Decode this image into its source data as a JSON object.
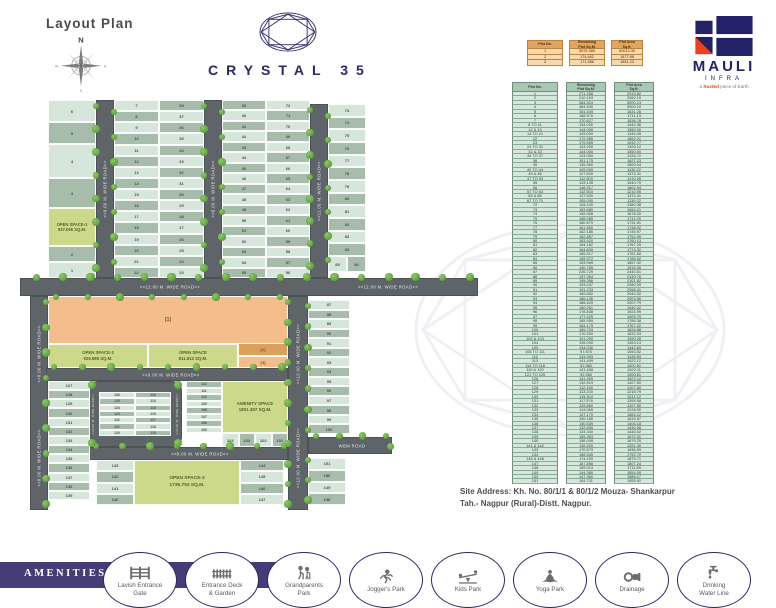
{
  "header": {
    "layout_plan": "Layout Plan",
    "project_title": "CRYSTAL 35"
  },
  "brand": {
    "name": "MAULI",
    "sub": "INFRA",
    "tagline_pre": "a ",
    "tagline_em": "trusted",
    "tagline_post": " piece of Earth"
  },
  "compass": {
    "n": "N",
    "e": "E",
    "s": "S",
    "w": "W"
  },
  "colors": {
    "accent_navy": "#2b2866",
    "brand_red": "#e8431e",
    "road_gray": "#5f6468",
    "plot_light": "#d7e6da",
    "plot_dark": "#a7bcab",
    "open_space_green": "#ccd98b",
    "orange_plot": "#f3bd8c",
    "orange_plot_dark": "#dba15c",
    "amenities_band": "#453c78",
    "table_green_row": "#d6e8dc",
    "table_orange_row": "#f8d9ae"
  },
  "summary_table": {
    "headers": [
      "Plot No.",
      "Remaining\nPlot Sq.M.",
      "Plot Area\nSq.ft."
    ],
    "rows": [
      [
        "1",
        "5575.380",
        "60013.39"
      ],
      [
        "2",
        "174.462",
        "1877.88"
      ],
      [
        "3",
        "171.986",
        "1851.23"
      ]
    ]
  },
  "plot_table": {
    "headers": [
      "Plot No.",
      "Remaining\nPlot Sq.M.",
      "Plot Area\nSq.ft."
    ],
    "rows": [
      [
        "1",
        "271.258",
        "2919.82"
      ],
      [
        "2",
        "210.163",
        "2262.19"
      ],
      [
        "3",
        "464.524",
        "5000.13"
      ],
      [
        "4",
        "464.530",
        "5000.19"
      ],
      [
        "5",
        "151.549",
        "1631.26"
      ],
      [
        "6",
        "158.970",
        "1711.13"
      ],
      [
        "7",
        "170.827",
        "1838.78"
      ],
      [
        "8 TO 11",
        "134.000",
        "1442.36"
      ],
      [
        "12 & 13",
        "144.000",
        "1550.00"
      ],
      [
        "14 TO 21",
        "125.000",
        "1345.49"
      ],
      [
        "22",
        "172.985",
        "1862.01"
      ],
      [
        "23",
        "179.559",
        "1932.77"
      ],
      [
        "24 TO 31",
        "123.200",
        "1326.12"
      ],
      [
        "32 & 33",
        "144.000",
        "1550.00"
      ],
      [
        "34 TO 37",
        "124.000",
        "1334.72"
      ],
      [
        "38",
        "151.175",
        "1627.23"
      ],
      [
        "39",
        "139.360",
        "1500.04"
      ],
      [
        "40 TO 44",
        "105.000",
        "1130.22"
      ],
      [
        "45 & 46",
        "127.500",
        "1372.41"
      ],
      [
        "47 TO 54",
        "112.500",
        "1210.95"
      ],
      [
        "55",
        "143.135",
        "1540.70"
      ],
      [
        "56",
        "148.917",
        "1602.94"
      ],
      [
        "57 TO 64",
        "112.500",
        "1210.95"
      ],
      [
        "65 & 66",
        "127.500",
        "1372.41"
      ],
      [
        "67 TO 71",
        "105.000",
        "1130.22"
      ],
      [
        "72",
        "128.240",
        "1380.38"
      ],
      [
        "73",
        "153.680",
        "1654.21"
      ],
      [
        "74",
        "155.908",
        "1678.20"
      ],
      [
        "75",
        "158.985",
        "1711.29"
      ],
      [
        "76",
        "160.870",
        "1731.61"
      ],
      [
        "77",
        "161.550",
        "1738.92"
      ],
      [
        "78",
        "162.186",
        "1745.97"
      ],
      [
        "79",
        "162.857",
        "1752.99"
      ],
      [
        "80",
        "163.520",
        "1760.13"
      ],
      [
        "81",
        "164.182",
        "1767.25"
      ],
      [
        "82",
        "164.839",
        "1774.32"
      ],
      [
        "83",
        "165.517",
        "1781.60"
      ],
      [
        "84",
        "165.972",
        "1786.52"
      ],
      [
        "85",
        "153.969",
        "1657.32"
      ],
      [
        "86",
        "140.755",
        "1515.05"
      ],
      [
        "87",
        "226.729",
        "2440.51"
      ],
      [
        "88",
        "197.954",
        "2130.76"
      ],
      [
        "89",
        "195.266",
        "2101.82"
      ],
      [
        "90",
        "193.247",
        "2080.09"
      ],
      [
        "91",
        "191.233",
        "2058.41"
      ],
      [
        "92",
        "189.552",
        "2040.32"
      ],
      [
        "93",
        "186.136",
        "2003.56"
      ],
      [
        "94",
        "186.529",
        "2007.79"
      ],
      [
        "95",
        "180.261",
        "1940.32"
      ],
      [
        "96",
        "178.838",
        "1924.99"
      ],
      [
        "97",
        "177.425",
        "1909.79"
      ],
      [
        "98",
        "165.959",
        "1786.38"
      ],
      [
        "99",
        "164.179",
        "1767.22"
      ],
      [
        "100",
        "169.703",
        "1826.68"
      ],
      [
        "101",
        "170.200",
        "1832.03"
      ],
      [
        "102 & 103",
        "101.290",
        "1090.28"
      ],
      [
        "104",
        "135.000",
        "1453.13"
      ],
      [
        "105",
        "134.030",
        "1442.69"
      ],
      [
        "106 TO 111",
        "97.875",
        "1053.52"
      ],
      [
        "112",
        "133.393",
        "1435.83"
      ],
      [
        "113",
        "141.409",
        "1522.12"
      ],
      [
        "114 TO 118",
        "92.960",
        "1000.61"
      ],
      [
        "119 & 120",
        "141.408",
        "1522.11"
      ],
      [
        "121 TO 125",
        "92.960",
        "1000.61"
      ],
      [
        "126",
        "141.409",
        "1522.12"
      ],
      [
        "127",
        "132.619",
        "1427.50"
      ],
      [
        "128",
        "112.190",
        "1207.60"
      ],
      [
        "129",
        "113.230",
        "1218.79"
      ],
      [
        "130",
        "115.304",
        "1241.12"
      ],
      [
        "131",
        "117.576",
        "1265.58"
      ],
      [
        "132",
        "129.860",
        "1397.80"
      ],
      [
        "133",
        "114.085",
        "1228.00"
      ],
      [
        "134",
        "147.170",
        "1584.12"
      ],
      [
        "135",
        "150.185",
        "1616.57"
      ],
      [
        "136",
        "130.639",
        "1406.18"
      ],
      [
        "137",
        "132.859",
        "1430.08"
      ],
      [
        "138",
        "134.340",
        "1446.02"
      ],
      [
        "139",
        "155.363",
        "1672.31"
      ],
      [
        "140",
        "156.008",
        "1679.25"
      ],
      [
        "141 & 142",
        "116.250",
        "1251.30"
      ],
      [
        "143",
        "170.579",
        "1836.09"
      ],
      [
        "144",
        "166.549",
        "1792.72"
      ],
      [
        "145 & 146",
        "174.259",
        "1875.71"
      ],
      [
        "147",
        "167.898",
        "1807.24"
      ],
      [
        "148",
        "159.013",
        "1711.59"
      ],
      [
        "149",
        "144.380",
        "1554.09"
      ],
      [
        "150",
        "147.360",
        "1586.17"
      ],
      [
        "151",
        "181.711",
        "1955.92"
      ]
    ]
  },
  "map": {
    "road_labels": {
      "r9": "<<9.00 M. WIDE ROAD>>",
      "r11": "<<11.00 M. WIDE ROAD>>",
      "r12": "<<12.00 M. WIDE ROAD>>",
      "wbm": "WBM ROAD"
    },
    "open_spaces": {
      "os1": {
        "name": "OPEN SPACE-1",
        "area": "937.096 SQ.M."
      },
      "os2": {
        "name": "OPEN SPACE-2",
        "area": "926.986 SQ.M."
      },
      "os_mid": {
        "name": "OPEN SPACE",
        "area": "811.513 SQ.M."
      },
      "amenity": {
        "name": "AMENITY SPACE",
        "area": "1801.397 SQ.M."
      },
      "os3": {
        "name": "OPEN SPACE-3",
        "area": "1735.753 SQ.M."
      }
    },
    "orange_labels": [
      "[1]",
      "[2]",
      "[3]"
    ],
    "columns": {
      "top_left": [
        "6",
        "5",
        "4",
        "3",
        "2",
        "1"
      ],
      "col_a": [
        "7",
        "8",
        "9",
        "10",
        "11",
        "12",
        "13",
        "14",
        "15",
        "16",
        "17",
        "18",
        "19",
        "20",
        "21",
        "22"
      ],
      "col_b": [
        "38",
        "37",
        "36",
        "35",
        "34",
        "33",
        "32",
        "31",
        "30",
        "29",
        "28",
        "27",
        "26",
        "25",
        "24",
        "23"
      ],
      "col_c": [
        "39",
        "40",
        "41",
        "42",
        "43",
        "44",
        "45",
        "46",
        "47",
        "48",
        "49",
        "50",
        "51",
        "52",
        "53",
        "54",
        "55"
      ],
      "col_d": [
        "72",
        "71",
        "70",
        "69",
        "68",
        "67",
        "66",
        "65",
        "64",
        "63",
        "62",
        "61",
        "60",
        "59",
        "58",
        "57",
        "56"
      ],
      "col_e": [
        "73",
        "74",
        "75",
        "76",
        "77",
        "78",
        "79",
        "80",
        "81",
        "82",
        "83",
        "84"
      ],
      "pair": [
        "85",
        "86"
      ],
      "mid_left": [
        "127",
        "128",
        "129",
        "130",
        "131",
        "132",
        "133",
        "134",
        "135",
        "136",
        "137",
        "138",
        "139"
      ],
      "island_left": [
        "126",
        "125",
        "124",
        "123",
        "122",
        "121",
        "120"
      ],
      "island_right": [
        "113",
        "114",
        "115",
        "116",
        "117",
        "118",
        "119"
      ],
      "col_112": [
        "112",
        "111",
        "110",
        "109",
        "108",
        "107",
        "106",
        "105"
      ],
      "bottom_row": [
        "104",
        "103",
        "102",
        "101"
      ],
      "col_87": [
        "87",
        "88",
        "89",
        "90",
        "91",
        "92",
        "93",
        "94",
        "95",
        "96",
        "97",
        "98",
        "99",
        "100"
      ],
      "col_148": [
        "151",
        "150",
        "149",
        "148"
      ],
      "bottom_left": [
        "143",
        "142",
        "141",
        "140"
      ],
      "bottom_right": [
        "144",
        "145",
        "146",
        "147"
      ]
    }
  },
  "site_address": {
    "line1": "Site Address: Kh. No. 80/1/1 & 80/1/2  Mouza- Shankarpur",
    "line2": "Tah.- Nagpur (Rural)-Distt. Nagpur."
  },
  "amenities": {
    "band_label": "AMENITIES",
    "items": [
      {
        "label": "Lavish Entrance\nGate",
        "icon": "entrance-gate-icon"
      },
      {
        "label": "Entrance Deck\n& Garden",
        "icon": "entrance-deck-garden-icon"
      },
      {
        "label": "Grandparents\nPark",
        "icon": "grandparents-park-icon"
      },
      {
        "label": "Jogger's Park",
        "icon": "joggers-park-icon"
      },
      {
        "label": "Kids Park",
        "icon": "kids-park-icon"
      },
      {
        "label": "Yoga Park",
        "icon": "yoga-park-icon"
      },
      {
        "label": "Drainage",
        "icon": "drainage-icon"
      },
      {
        "label": "Drinking\nWater Line",
        "icon": "drinking-water-icon"
      }
    ]
  }
}
